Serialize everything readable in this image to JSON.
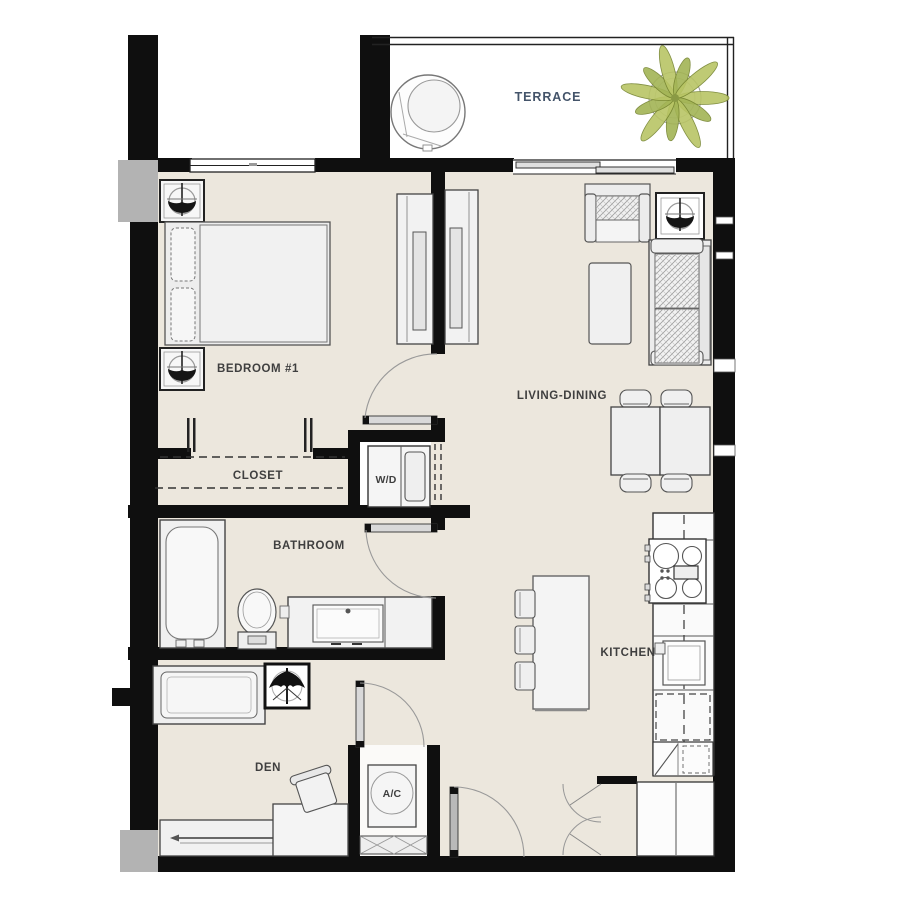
{
  "labels": {
    "terrace": "TERRACE",
    "bedroom": "BEDROOM #1",
    "closet": "CLOSET",
    "washer_dryer": "W/D",
    "bathroom": "BATHROOM",
    "living_dining": "LIVING-DINING",
    "kitchen": "KITCHEN",
    "den": "DEN",
    "ac": "A/C"
  },
  "colors": {
    "wall": "#0f0f0f",
    "floor": "#ece7dd",
    "furniture_fill": "#f0f0f0",
    "furniture_outline": "#4a4a4a",
    "room_label": "#3f3f3f",
    "terrace_label": "#44546a",
    "plant_green": "#b9c565",
    "plant_green_dark": "#a3b455",
    "door_leaf": "#d9d9d9",
    "exterior_gray": "#b3b3b3"
  }
}
